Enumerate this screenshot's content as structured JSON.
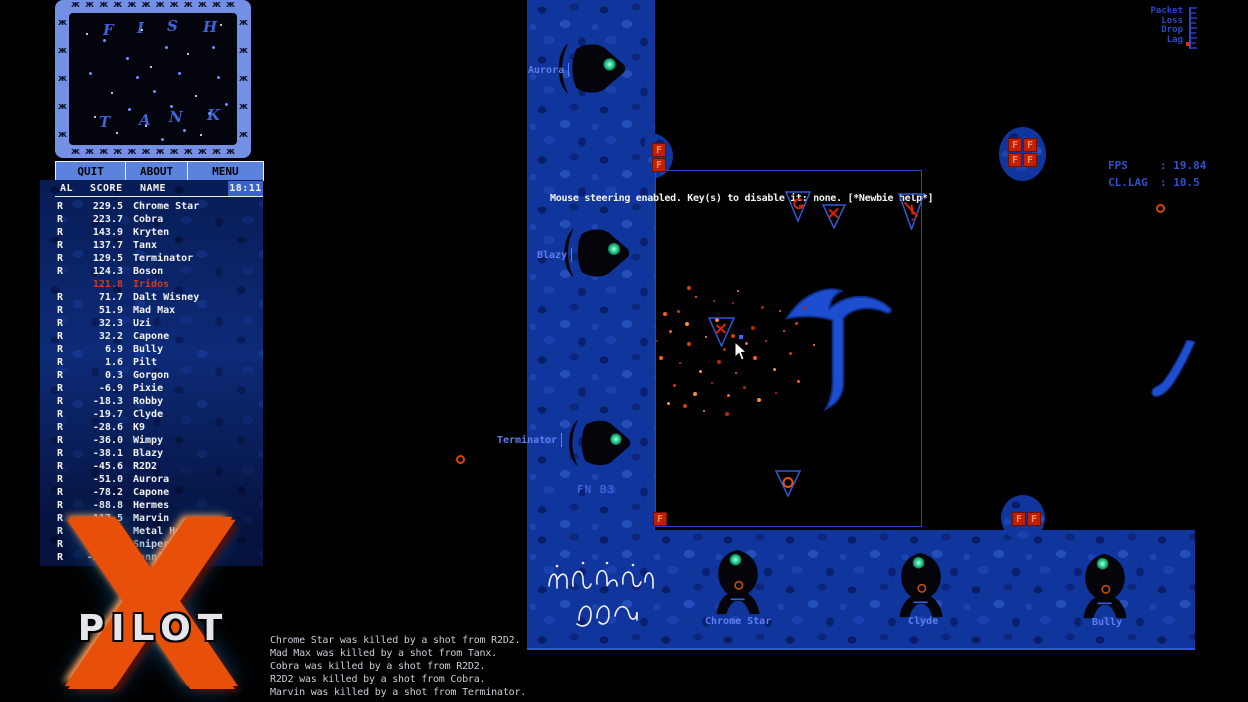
{
  "app": {
    "name": "XPilot"
  },
  "radar": {
    "letters": [
      "F",
      "I",
      "S",
      "H",
      "T",
      "A",
      "N",
      "K"
    ]
  },
  "icons": {
    "radar_border_fish": "ж"
  },
  "menu": {
    "quit": "QUIT",
    "about": "ABOUT",
    "menu": "MENU"
  },
  "score_header": {
    "al": "AL",
    "score": "SCORE",
    "name": "NAME",
    "time": "18:11"
  },
  "scores": [
    {
      "flag": "R",
      "score": "229.5",
      "name": "Chrome Star"
    },
    {
      "flag": "R",
      "score": "223.7",
      "name": "Cobra"
    },
    {
      "flag": "R",
      "score": "143.9",
      "name": "Kryten"
    },
    {
      "flag": "R",
      "score": "137.7",
      "name": "Tanx"
    },
    {
      "flag": "R",
      "score": "129.5",
      "name": "Terminator"
    },
    {
      "flag": "R",
      "score": "124.3",
      "name": "Boson"
    },
    {
      "flag": "",
      "score": "121.8",
      "name": "Iridos",
      "cls": "self"
    },
    {
      "flag": "R",
      "score": "71.7",
      "name": "Dalt Wisney"
    },
    {
      "flag": "R",
      "score": "51.9",
      "name": "Mad Max"
    },
    {
      "flag": "R",
      "score": "32.3",
      "name": "Uzi"
    },
    {
      "flag": "R",
      "score": "32.2",
      "name": "Capone"
    },
    {
      "flag": "R",
      "score": "6.9",
      "name": "Bully"
    },
    {
      "flag": "R",
      "score": "1.6",
      "name": "Pilt"
    },
    {
      "flag": "R",
      "score": "0.3",
      "name": "Gorgon"
    },
    {
      "flag": "R",
      "score": "-6.9",
      "name": "Pixie"
    },
    {
      "flag": "R",
      "score": "-18.3",
      "name": "Robby"
    },
    {
      "flag": "R",
      "score": "-19.7",
      "name": "Clyde"
    },
    {
      "flag": "R",
      "score": "-28.6",
      "name": "K9"
    },
    {
      "flag": "R",
      "score": "-36.0",
      "name": "Wimpy"
    },
    {
      "flag": "R",
      "score": "-38.1",
      "name": "Blazy"
    },
    {
      "flag": "R",
      "score": "-45.6",
      "name": "R2D2"
    },
    {
      "flag": "R",
      "score": "-51.0",
      "name": "Aurora"
    },
    {
      "flag": "R",
      "score": "-78.2",
      "name": "Capone"
    },
    {
      "flag": "R",
      "score": "-88.8",
      "name": "Hermes"
    },
    {
      "flag": "R",
      "score": "-117.5",
      "name": "Marvin"
    },
    {
      "flag": "R",
      "score": "-121.8",
      "name": "Metal Hero"
    },
    {
      "flag": "R",
      "score": "-157.1",
      "name": "Sniper"
    },
    {
      "flag": "R",
      "score": "-231.4",
      "name": "Bonnie"
    }
  ],
  "logo": {
    "x_letter": "X",
    "title": "PILOT"
  },
  "game": {
    "status_message": "Mouse steering enabled. Key(s) to disable it: none. [*Newbie help*]",
    "sector_label": "FN B3",
    "fps": {
      "label": "FPS",
      "value": ": 19.84"
    },
    "lag": {
      "label": "CL.LAG",
      "value": ": 10.5"
    },
    "net_meter_labels": [
      "Packet",
      "Loss",
      "Drop",
      "Lag"
    ],
    "fuel_letter": "F",
    "labels": {
      "aurora": "Aurora",
      "blazy": "Blazy",
      "terminator": "Terminator",
      "chrome_star": "Chrome Star",
      "clyde": "Clyde",
      "bully": "Bully"
    }
  },
  "kill_feed": [
    "Chrome Star was killed by a shot from R2D2.",
    "Mad Max was killed by a shot from Tanx.",
    "Cobra was killed by a shot from R2D2.",
    "R2D2 was killed by a shot from Cobra.",
    "Marvin was killed by a shot from Terminator."
  ],
  "colors": {
    "water": "#10359c",
    "hud_text": "#2f51cc",
    "self_score": "#cf3a20",
    "fuel_red": "#c21f00",
    "eye_green": "#35e0a0",
    "logo_orange": "#e8500a",
    "map_label_blue": "#5f7df0"
  }
}
